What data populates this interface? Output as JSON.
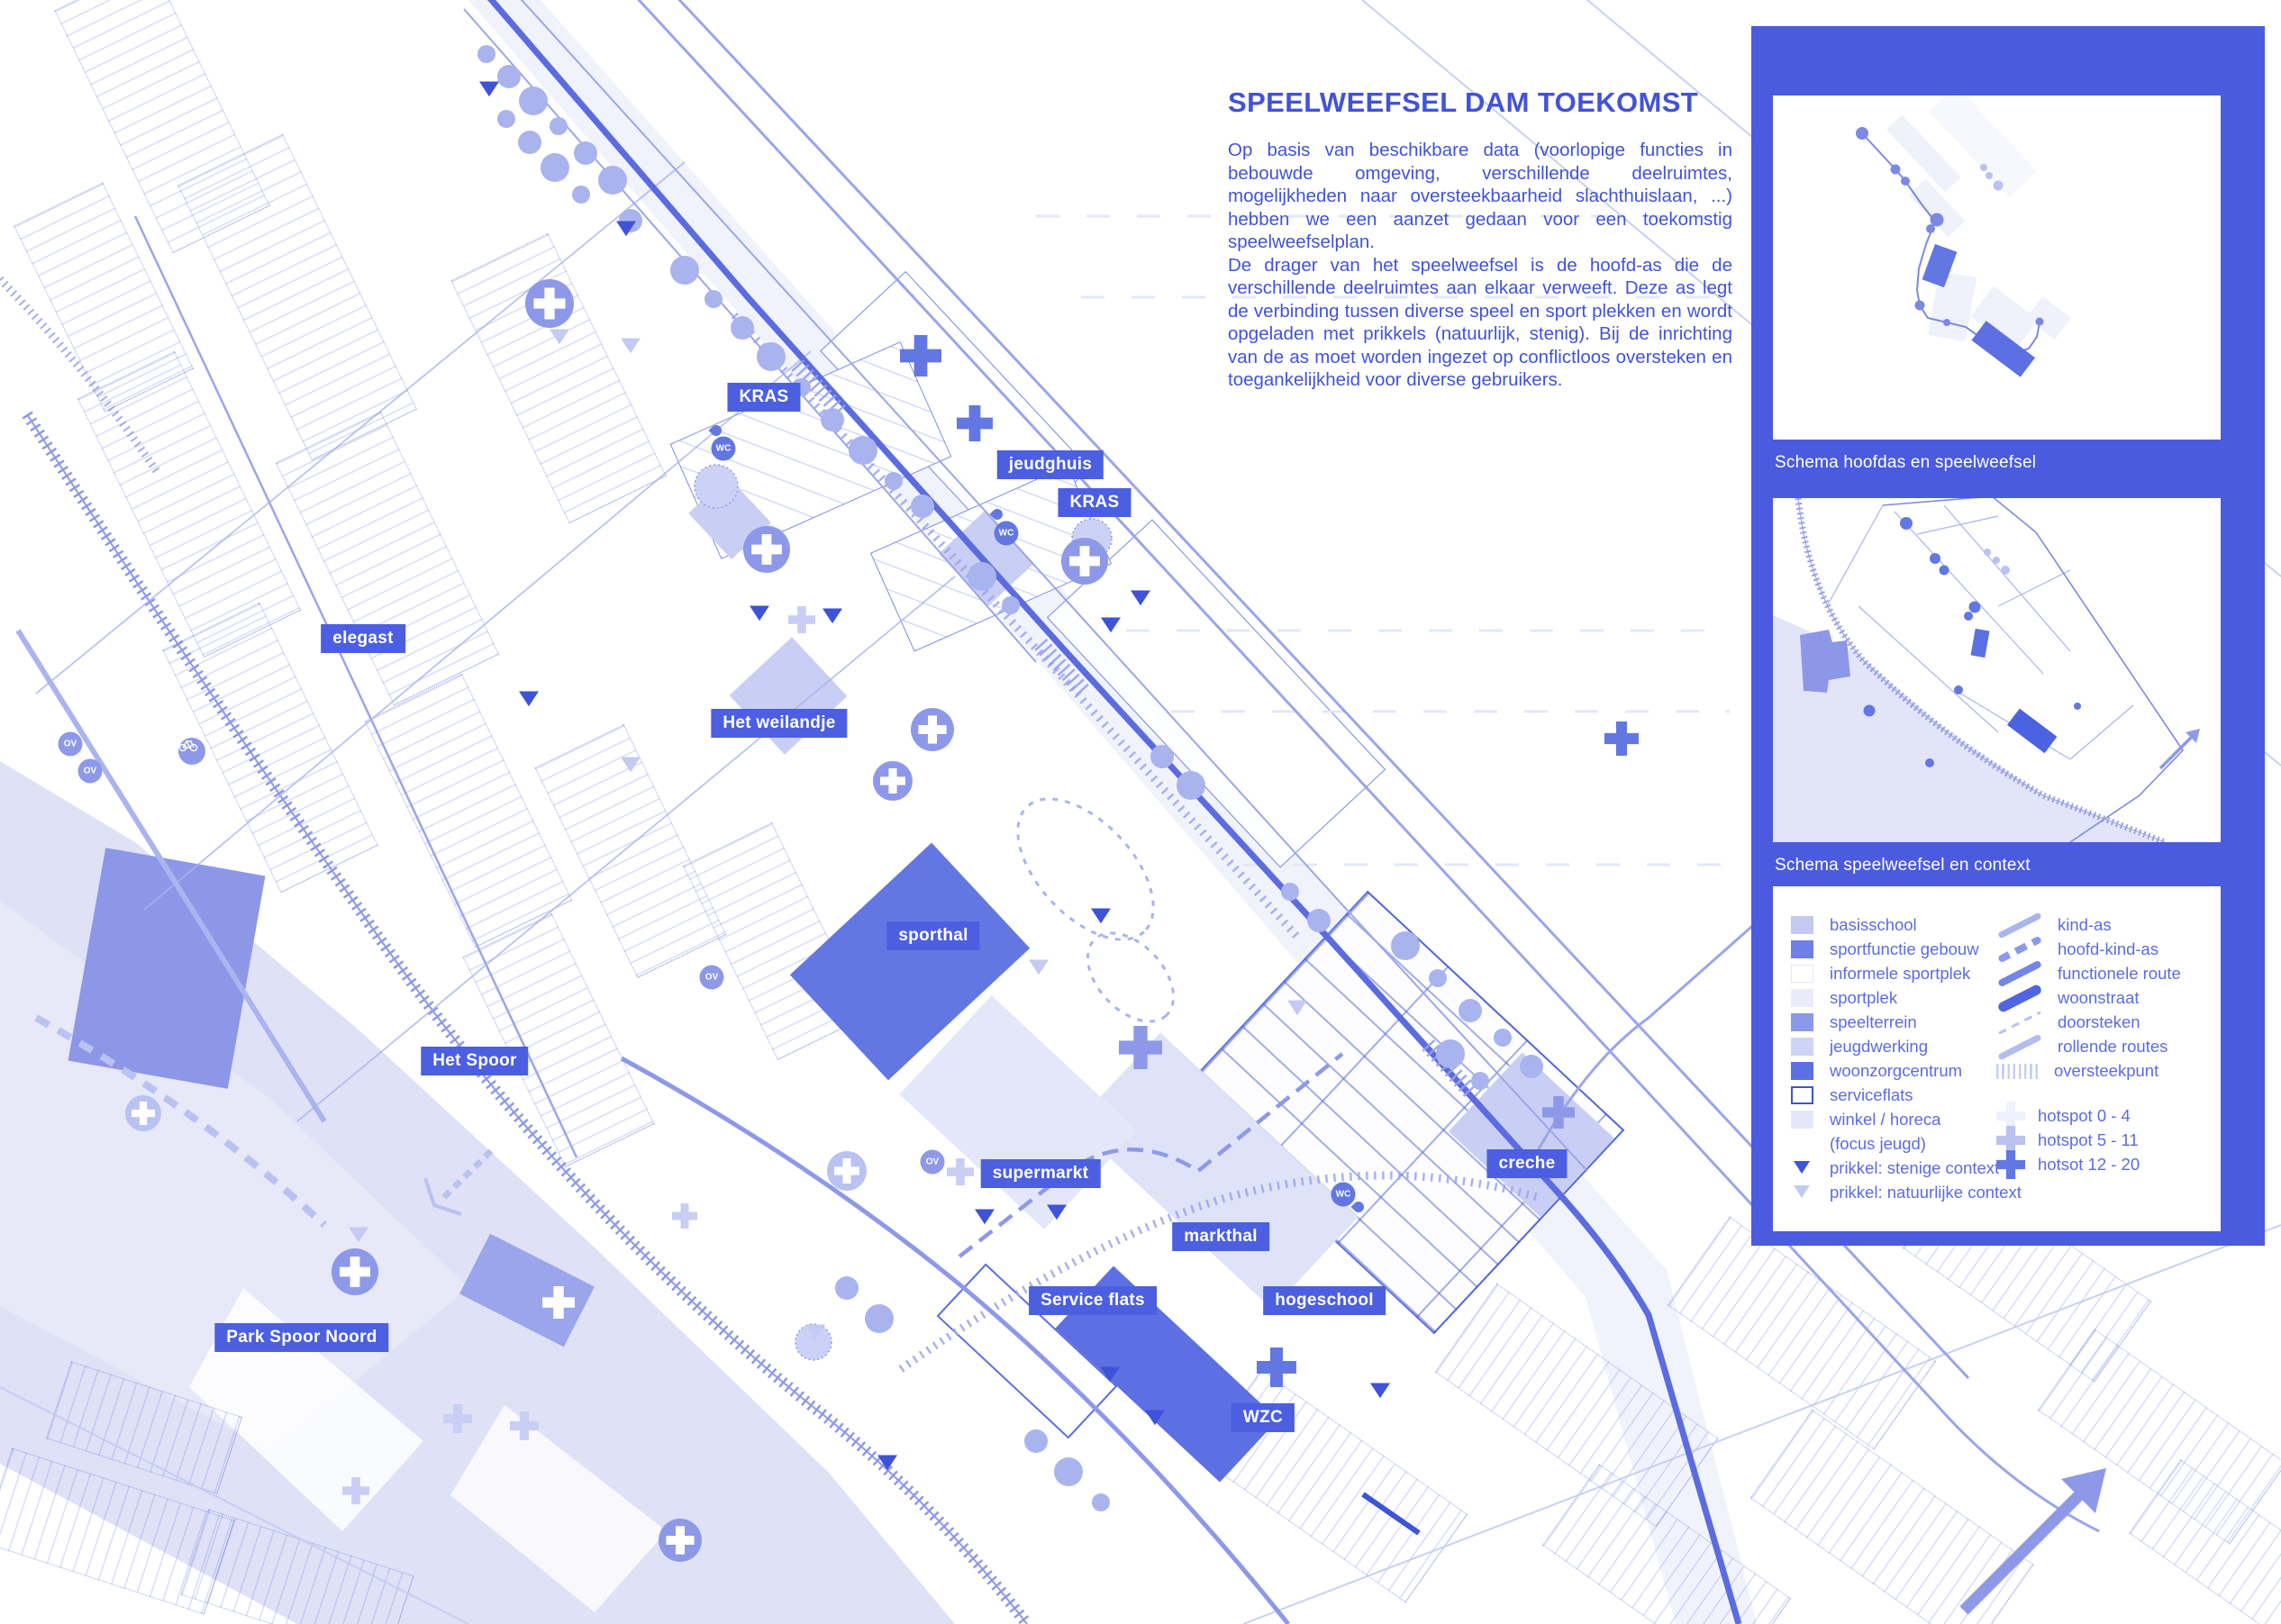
{
  "colors": {
    "panel_blue": "#4a5be0",
    "badge_blue": "#4b5fe0",
    "ink_blue": "#4153d9",
    "legend_text": "#5b6ce0",
    "map_line": "#3c55d5"
  },
  "article": {
    "title": "SPEELWEEFSEL DAM TOEKOMST",
    "p1": "Op basis van beschikbare data (voorlopige functies in bebouwde omgeving, verschillende deelruimtes, mogelijkheden naar oversteekbaarheid slachthuislaan, ...) hebben we een aanzet gedaan voor een toekomstig speelweefselplan.",
    "p2": "De drager van het speelweefsel is de hoofd-as die de verschillende deelruimtes aan elkaar verweeft. Deze as legt de verbinding tussen diverse speel en sport plekken en wordt opgeladen met prikkels (natuurlijk, stenig). Bij de inrichting van de as moet worden ingezet op conflictloos oversteken en toegankelijkheid voor diverse gebruikers."
  },
  "panel": {
    "schema1_caption": "Schema hoofdas en speelweefsel",
    "schema2_caption": "Schema speelweefsel en context"
  },
  "map": {
    "labels": [
      "KRAS",
      "jeudghuis",
      "KRAS",
      "elegast",
      "Het weilandje",
      "sporthal",
      "Het Spoor",
      "supermarkt",
      "markthal",
      "creche",
      "Service flats",
      "hogeschool",
      "WZC",
      "Park Spoor Noord"
    ],
    "chips": {
      "ov": "OV",
      "wc": "WC"
    }
  },
  "legend": {
    "areas": [
      {
        "label": "basisschool",
        "color": "#c3c9f1"
      },
      {
        "label": "sportfunctie gebouw",
        "color": "#6e7fe5"
      },
      {
        "label": "informele sportplek",
        "color": "#ffffff",
        "border": "#e2e5f9"
      },
      {
        "label": "sportplek",
        "color": "#e9ebfa"
      },
      {
        "label": "speelterrein",
        "color": "#8b99ea"
      },
      {
        "label": "jeugdwerking",
        "color": "#ced4f5"
      },
      {
        "label": "woonzorgcentrum",
        "color": "#5c6fe3"
      },
      {
        "label": "serviceflats",
        "color": "#ffffff",
        "border": "#3d55d4"
      },
      {
        "label": "winkel / horeca",
        "color": "#e4e7f9"
      },
      {
        "label": "(focus jeugd)",
        "color": null
      },
      {
        "label": "prikkel: stenige context",
        "color": "#3e53d8"
      },
      {
        "label": "prikkel: natuurlijke context",
        "color": "#c3cbf3"
      }
    ],
    "lines": [
      {
        "label": "kind-as",
        "color": "#aab5ef"
      },
      {
        "label": "hoofd-kind-as",
        "color": "#8b99ea"
      },
      {
        "label": "functionele route",
        "color": "#7385e6"
      },
      {
        "label": "woonstraat",
        "color": "#5265e0"
      },
      {
        "label": "doorsteken",
        "color": "#b9c2f1"
      },
      {
        "label": "rollende routes",
        "color": "#b3bcf0"
      },
      {
        "label": "oversteekpunt",
        "color": "#c9cff4"
      }
    ],
    "hotspots": [
      {
        "label": "hotspot 0 - 4",
        "color": "#eff1fc"
      },
      {
        "label": "hotspot 5 - 11",
        "color": "#b9c2f1"
      },
      {
        "label": "hotsot 12 - 20",
        "color": "#6377e3"
      }
    ]
  }
}
